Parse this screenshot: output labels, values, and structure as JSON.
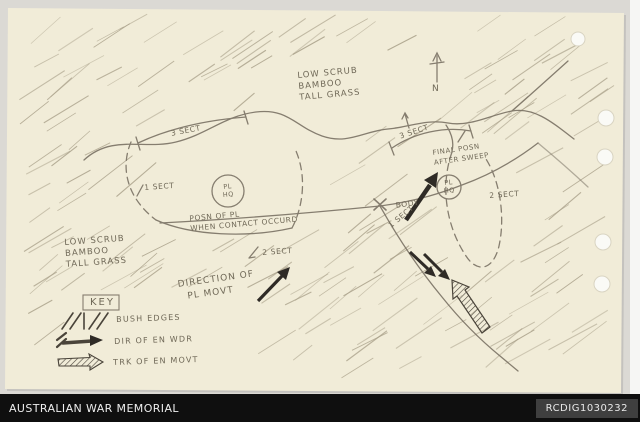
{
  "footer": {
    "title": "AUSTRALIAN WAR MEMORIAL",
    "id": "RCDIG1030232"
  },
  "map": {
    "north_label": "N",
    "vegetation_note_top": {
      "line1": "LOW SCRUB",
      "line2": "BAMBOO",
      "line3": "TALL GRASS"
    },
    "vegetation_note_left": {
      "line1": "LOW SCRUB",
      "line2": "BAMBOO",
      "line3": "TALL GRASS"
    },
    "units": {
      "sect3_left": "3 SECT",
      "sect1_left": "1 SECT",
      "sect2_left": "2 SECT",
      "sect3_right": "3 SECT",
      "sect1_right": "1 SECT",
      "sect2_right": "2 SECT",
      "pl_hq_start": {
        "line1": "PL",
        "line2": "HQ"
      },
      "pl_hq_final": {
        "line1": "PL",
        "line2": "HQ"
      }
    },
    "annotations": {
      "contact_line1": "POSN OF PL",
      "contact_line2": "WHEN CONTACT OCCURD",
      "final_line1": "FINAL POSN",
      "final_line2": "AFTER SWEEP",
      "body": "BODY",
      "direction_line1": "DIRECTION OF",
      "direction_line2": "PL MOVT"
    },
    "key": {
      "title": "KEY",
      "items": [
        {
          "symbol": "bush-hatch",
          "label": "BUSH EDGES"
        },
        {
          "symbol": "solid-arrow",
          "label": "DIR OF EN WDR"
        },
        {
          "symbol": "hatched-arrow",
          "label": "TRK OF EN MOVT"
        }
      ]
    }
  },
  "colors": {
    "paper": "#f1ecd8",
    "pencil": "#6f6857",
    "ink_dark": "#2f2b26",
    "footer_bg": "#0f0f0f",
    "footer_box": "#3f3f3f"
  }
}
